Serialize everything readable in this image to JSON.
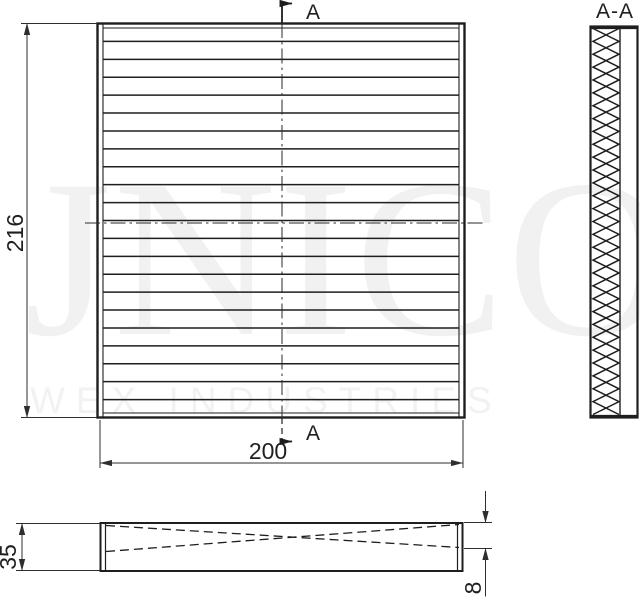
{
  "watermark": {
    "line1": "JNICO",
    "line2": "WEX INDUSTRIES"
  },
  "section_view": {
    "title": "A-A"
  },
  "cut_marker": {
    "top_label": "A",
    "bottom_label": "A"
  },
  "dimensions": {
    "front_height": "216",
    "front_width": "200",
    "side_height": "35",
    "side_edge_depth": "8"
  },
  "geometry": {
    "front_pleat_lines": 21,
    "section_zigzag_half_periods": 30
  },
  "colors": {
    "line": "#1e1e1e",
    "dim_line": "#2e2e2e",
    "watermark_large": "#f1f1f1",
    "watermark_small": "#f2f2f2",
    "background": "#ffffff"
  }
}
